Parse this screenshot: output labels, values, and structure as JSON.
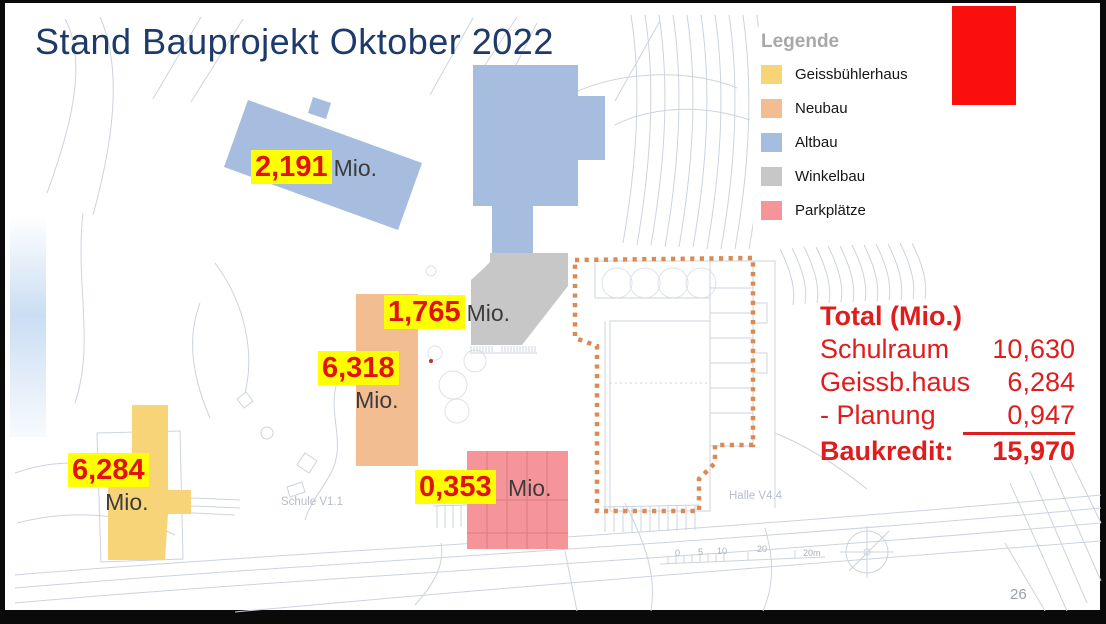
{
  "slide": {
    "title": "Stand Bauprojekt Oktober 2022",
    "page_number": "26"
  },
  "colors": {
    "title_blue": "#1e3a68",
    "accent_red": "#fb0f0c",
    "cost_text_red": "#e01212",
    "totals_red": "#e01d1d",
    "highlight_yellow": "#ffff00",
    "legend_heading_gray": "#a8a8a8",
    "dashed_outline_orange": "#da8a52"
  },
  "legend": {
    "heading": "Legende",
    "items": [
      {
        "label": "Geissbühlerhaus",
        "color": "#f7d478"
      },
      {
        "label": "Neubau",
        "color": "#f3bd92"
      },
      {
        "label": "Altbau",
        "color": "#a6bde0"
      },
      {
        "label": "Winkelbau",
        "color": "#c7c7c7"
      },
      {
        "label": "Parkplätze",
        "color": "#f5959a"
      }
    ]
  },
  "cost_labels": [
    {
      "building": "Altbau",
      "value": "2,191",
      "unit": "Mio."
    },
    {
      "building": "Winkelbau",
      "value": "1,765",
      "unit": "Mio."
    },
    {
      "building": "Neubau",
      "value": "6,318",
      "unit": "Mio."
    },
    {
      "building": "Geissbühlerhaus",
      "value": "6,284",
      "unit": "Mio."
    },
    {
      "building": "Parkplätze",
      "value": "0,353",
      "unit": "Mio."
    }
  ],
  "totals": {
    "heading": "Total (Mio.)",
    "rows": [
      {
        "label": "Schulraum",
        "value": "10,630"
      },
      {
        "label": "Geissb.haus",
        "value": "6,284"
      },
      {
        "label": "-  Planung",
        "value": "0,947"
      }
    ],
    "total_row": {
      "label": "Baukredit:",
      "value": "15,970"
    }
  },
  "plan": {
    "labels": {
      "school": "Schule V1.1",
      "hall": "Halle V4.4"
    },
    "scale_bar": {
      "ticks": [
        "0",
        "5",
        "10",
        "20"
      ],
      "unit_label": "20m"
    }
  }
}
